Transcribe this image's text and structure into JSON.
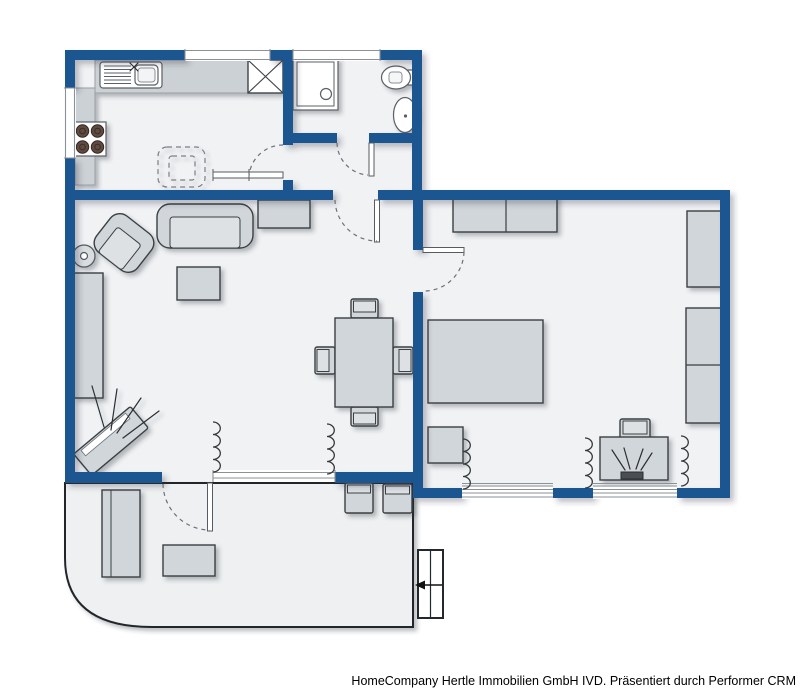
{
  "footer": {
    "credit": "HomeCompany Hertle Immobilien GmbH IVD. Präsentiert durch Performer CRM"
  },
  "colors": {
    "wall": "#1a5691",
    "floor": "#f1f2f4",
    "balcony-floor": "#eef0f1",
    "balcony-edge": "#23282c",
    "furniture": "#d1d6da",
    "furniture-light": "#dde1e4",
    "counter": "#cbd1d4",
    "counter-edge": "#9aa0a4",
    "outline": "#3a3f42",
    "fixture": "#ffffff",
    "fixture-stroke": "#5a6065",
    "burner": "#5e4b42",
    "door-arc": "#6b7075",
    "radiator": "#33383b",
    "window": "#ffffff",
    "window-line": "#8b9196",
    "footer-text": "#000000"
  },
  "plan": {
    "type": "apartment-floor-plan",
    "rooms": [
      {
        "name": "kitchen"
      },
      {
        "name": "bathroom"
      },
      {
        "name": "hallway"
      },
      {
        "name": "living-dining-room"
      },
      {
        "name": "bedroom"
      },
      {
        "name": "balcony-terrace"
      }
    ],
    "furniture_icons": [
      "kitchen-counter",
      "kitchen-sink",
      "stove",
      "ventilation-shaft",
      "dashed-kitchen-table",
      "shower",
      "toilet",
      "washbasin",
      "sofa",
      "armchair",
      "floor-lamp",
      "sideboard",
      "coffee-table",
      "tv",
      "dining-table",
      "dining-chair",
      "radiator",
      "wardrobe",
      "bed",
      "nightstand",
      "desk",
      "desk-chair",
      "cabinet",
      "lounger",
      "balcony-table",
      "balcony-chair",
      "entrance-steps",
      "entrance-arrow"
    ]
  }
}
